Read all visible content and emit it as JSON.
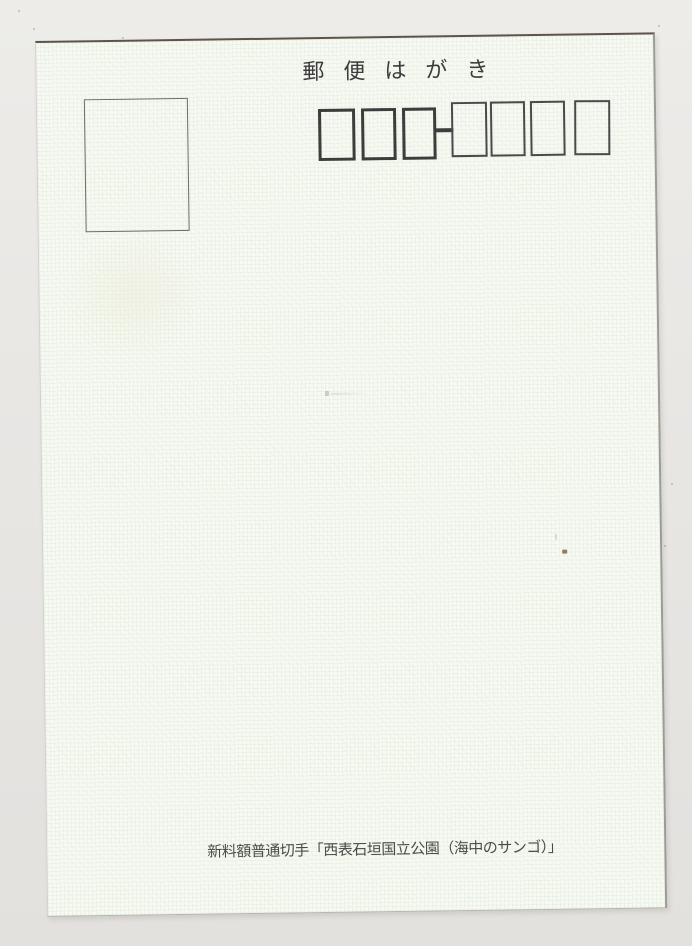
{
  "postcard": {
    "title": "郵便はがき",
    "postal_code_field": {
      "group1_count": 3,
      "separator": "-",
      "group2_count": 4
    },
    "footer_note": "新料額普通切手「西表石垣国立公園（海中のサンゴ）」"
  },
  "colors": {
    "background": "#e9e7e4",
    "card": "#f7faf2",
    "title_text": "#3c3c3c",
    "footer_text": "#4a4a48",
    "box_border_thick": "#3d3d3d",
    "box_border_thin": "#4a4a4a",
    "stamp_border": "#6b6b68",
    "card_top_edge": "#5d5348"
  }
}
